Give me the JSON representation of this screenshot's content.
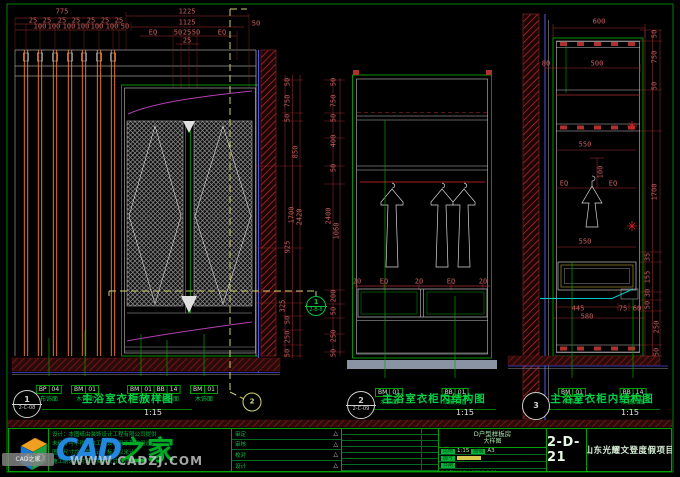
{
  "colors": {
    "accent_green": "#00a000",
    "dim_red": "#c86060",
    "hatch_red": "#b93030",
    "slat_orange": "#ff7f2a",
    "yellow_dash": "#cfcf6a",
    "magenta": "#b040b0",
    "cyan": "#00c8c8",
    "base_gray": "#8a93a3"
  },
  "drawing": {
    "dims": [
      [
        "775",
        62,
        12,
        0
      ],
      [
        "25",
        33,
        21,
        0
      ],
      [
        "25",
        47,
        21,
        0
      ],
      [
        "25",
        62,
        21,
        0
      ],
      [
        "25",
        76,
        21,
        0
      ],
      [
        "25",
        91,
        21,
        0
      ],
      [
        "25",
        105,
        21,
        0
      ],
      [
        "25",
        119,
        21,
        0
      ],
      [
        "100",
        40,
        27,
        0
      ],
      [
        "100",
        54,
        27,
        0
      ],
      [
        "100",
        69,
        27,
        0
      ],
      [
        "100",
        83,
        27,
        0
      ],
      [
        "100",
        97,
        27,
        0
      ],
      [
        "100",
        112,
        27,
        0
      ],
      [
        "50",
        125,
        27,
        0
      ],
      [
        "1225",
        187,
        12,
        0
      ],
      [
        "1125",
        187,
        23,
        0
      ],
      [
        "EQ",
        153,
        33,
        0
      ],
      [
        "50",
        178,
        33,
        0
      ],
      [
        "25",
        187,
        33,
        0
      ],
      [
        "50",
        196,
        33,
        0
      ],
      [
        "EQ",
        222,
        33,
        0
      ],
      [
        "25",
        187,
        41,
        0
      ],
      [
        "50",
        256,
        24,
        0
      ],
      [
        "50",
        288,
        82,
        1
      ],
      [
        "750",
        288,
        101,
        1
      ],
      [
        "50",
        288,
        118,
        1
      ],
      [
        "850",
        296,
        152,
        1
      ],
      [
        "1700",
        292,
        215,
        1
      ],
      [
        "2420",
        300,
        217,
        1
      ],
      [
        "925",
        288,
        247,
        1
      ],
      [
        "325",
        283,
        306,
        1
      ],
      [
        "50",
        288,
        320,
        1
      ],
      [
        "250",
        288,
        337,
        1
      ],
      [
        "50",
        288,
        353,
        1
      ],
      [
        "50",
        334,
        82,
        1
      ],
      [
        "750",
        334,
        101,
        1
      ],
      [
        "50",
        334,
        118,
        1
      ],
      [
        "400",
        334,
        141,
        1
      ],
      [
        "50",
        334,
        168,
        1
      ],
      [
        "2400",
        329,
        216,
        1
      ],
      [
        "1060",
        337,
        231,
        1
      ],
      [
        "200",
        334,
        296,
        1
      ],
      [
        "50",
        334,
        311,
        1
      ],
      [
        "250",
        334,
        336,
        1
      ],
      [
        "50",
        334,
        353,
        1
      ],
      [
        "20",
        357,
        282,
        0
      ],
      [
        "EQ",
        384,
        282,
        0
      ],
      [
        "20",
        419,
        282,
        0
      ],
      [
        "EQ",
        451,
        282,
        0
      ],
      [
        "20",
        483,
        282,
        0
      ],
      [
        "600",
        599,
        22,
        0
      ],
      [
        "80",
        546,
        64,
        0
      ],
      [
        "500",
        597,
        64,
        0
      ],
      [
        "550",
        585,
        145,
        0
      ],
      [
        "100",
        601,
        172,
        1
      ],
      [
        "EQ",
        564,
        184,
        0
      ],
      [
        "EQ",
        613,
        184,
        0
      ],
      [
        "550",
        585,
        242,
        0
      ],
      [
        "445",
        578,
        309,
        0
      ],
      [
        "75",
        623,
        309,
        0
      ],
      [
        "60",
        637,
        309,
        0
      ],
      [
        "580",
        587,
        317,
        0
      ],
      [
        "50",
        655,
        34,
        1
      ],
      [
        "750",
        655,
        57,
        1
      ],
      [
        "50",
        655,
        86,
        1
      ],
      [
        "1700",
        655,
        192,
        1
      ],
      [
        "35",
        648,
        257,
        1
      ],
      [
        "155",
        648,
        277,
        1
      ],
      [
        "30",
        648,
        293,
        1
      ],
      [
        "50",
        648,
        305,
        1
      ],
      [
        "250",
        657,
        327,
        1
      ],
      [
        "50",
        657,
        352,
        1
      ]
    ],
    "material_tags": [
      {
        "x": 49,
        "y": 376,
        "code": "BP",
        "num": "04",
        "label": "布饰面"
      },
      {
        "x": 85,
        "y": 376,
        "code": "BM",
        "num": "01",
        "label": "木饰面"
      },
      {
        "x": 141,
        "y": 376,
        "code": "BM",
        "num": "01",
        "label": "木饰面"
      },
      {
        "x": 167,
        "y": 376,
        "code": "BB",
        "num": "14",
        "label": "灰镜饰面"
      },
      {
        "x": 204,
        "y": 376,
        "code": "BM",
        "num": "01",
        "label": "木饰面"
      },
      {
        "x": 389,
        "y": 379,
        "code": "BM",
        "num": "01",
        "label": "木饰面"
      },
      {
        "x": 455,
        "y": 379,
        "code": "BB",
        "num": "01",
        "label": "暗藏光管"
      },
      {
        "x": 572,
        "y": 379,
        "code": "BM",
        "num": "01",
        "label": "木饰面"
      },
      {
        "x": 633,
        "y": 379,
        "code": "BB",
        "num": "14",
        "label": "灰镜饰面"
      }
    ],
    "markers": [
      {
        "x": 27,
        "y": 404,
        "num": "1",
        "ref": "2-C-08",
        "kind": "panel"
      },
      {
        "x": 361,
        "y": 405,
        "num": "2",
        "ref": "2-C-09",
        "kind": "panel"
      },
      {
        "x": 536,
        "y": 406,
        "num": "3",
        "ref": "",
        "kind": "panel"
      },
      {
        "x": 252,
        "y": 402,
        "num": "2",
        "ref": "",
        "kind": "section"
      },
      {
        "x": 316,
        "y": 306,
        "num": "1",
        "ref": "2-B-8",
        "kind": "section-small"
      }
    ],
    "panel_titles": [
      {
        "x": 128,
        "y": 394,
        "title": "主浴室衣柜放样图",
        "scale": "1:15",
        "sx": 153,
        "sy": 409
      },
      {
        "x": 434,
        "y": 394,
        "title": "主浴室衣柜内结构图",
        "scale": "1:15",
        "sx": 465,
        "sy": 409
      },
      {
        "x": 602,
        "y": 394,
        "title": "主浴室衣柜内结构图",
        "scale": "1:15",
        "sx": 630,
        "sy": 409
      }
    ]
  },
  "title_block": {
    "notes": [
      "设计：本图纸由装饰设计工程有限公司提供",
      "未经许可不得将本工程设计用于其他用途",
      "图中尺寸均以毫米计，标高以米计",
      "施工前须核对现场实际尺寸后方可施工"
    ],
    "approval_rows": [
      {
        "label": "审定",
        "mark": "△"
      },
      {
        "label": "审核",
        "mark": "△"
      },
      {
        "label": "校对",
        "mark": "△"
      },
      {
        "label": "设计",
        "mark": "△"
      }
    ],
    "revision_row_count": 7,
    "sheet_title_line1": "D户型样板房",
    "sheet_title_line2": "大样图",
    "info_rows": [
      {
        "l": "比例",
        "v": "1:15",
        "l2": "图幅",
        "v2": "A3",
        "yellow": false
      },
      {
        "l": "图号",
        "v": "",
        "l2": "",
        "v2": "",
        "yellow": true
      },
      {
        "l": "日期",
        "v": "",
        "l2": "",
        "v2": "",
        "yellow": false
      }
    ],
    "info_footer": "D户型样板房大样图 2-D-21",
    "drawing_number": "2-D-21",
    "project_name": "山东光耀文登度假项目"
  },
  "watermark": {
    "brand_blue": "CAD",
    "brand_green": "之家",
    "url": "WWW.CADZJ.COM",
    "badge": "CAD之家",
    "cube_letter_a": "A",
    "cube_letter_d": "D"
  }
}
